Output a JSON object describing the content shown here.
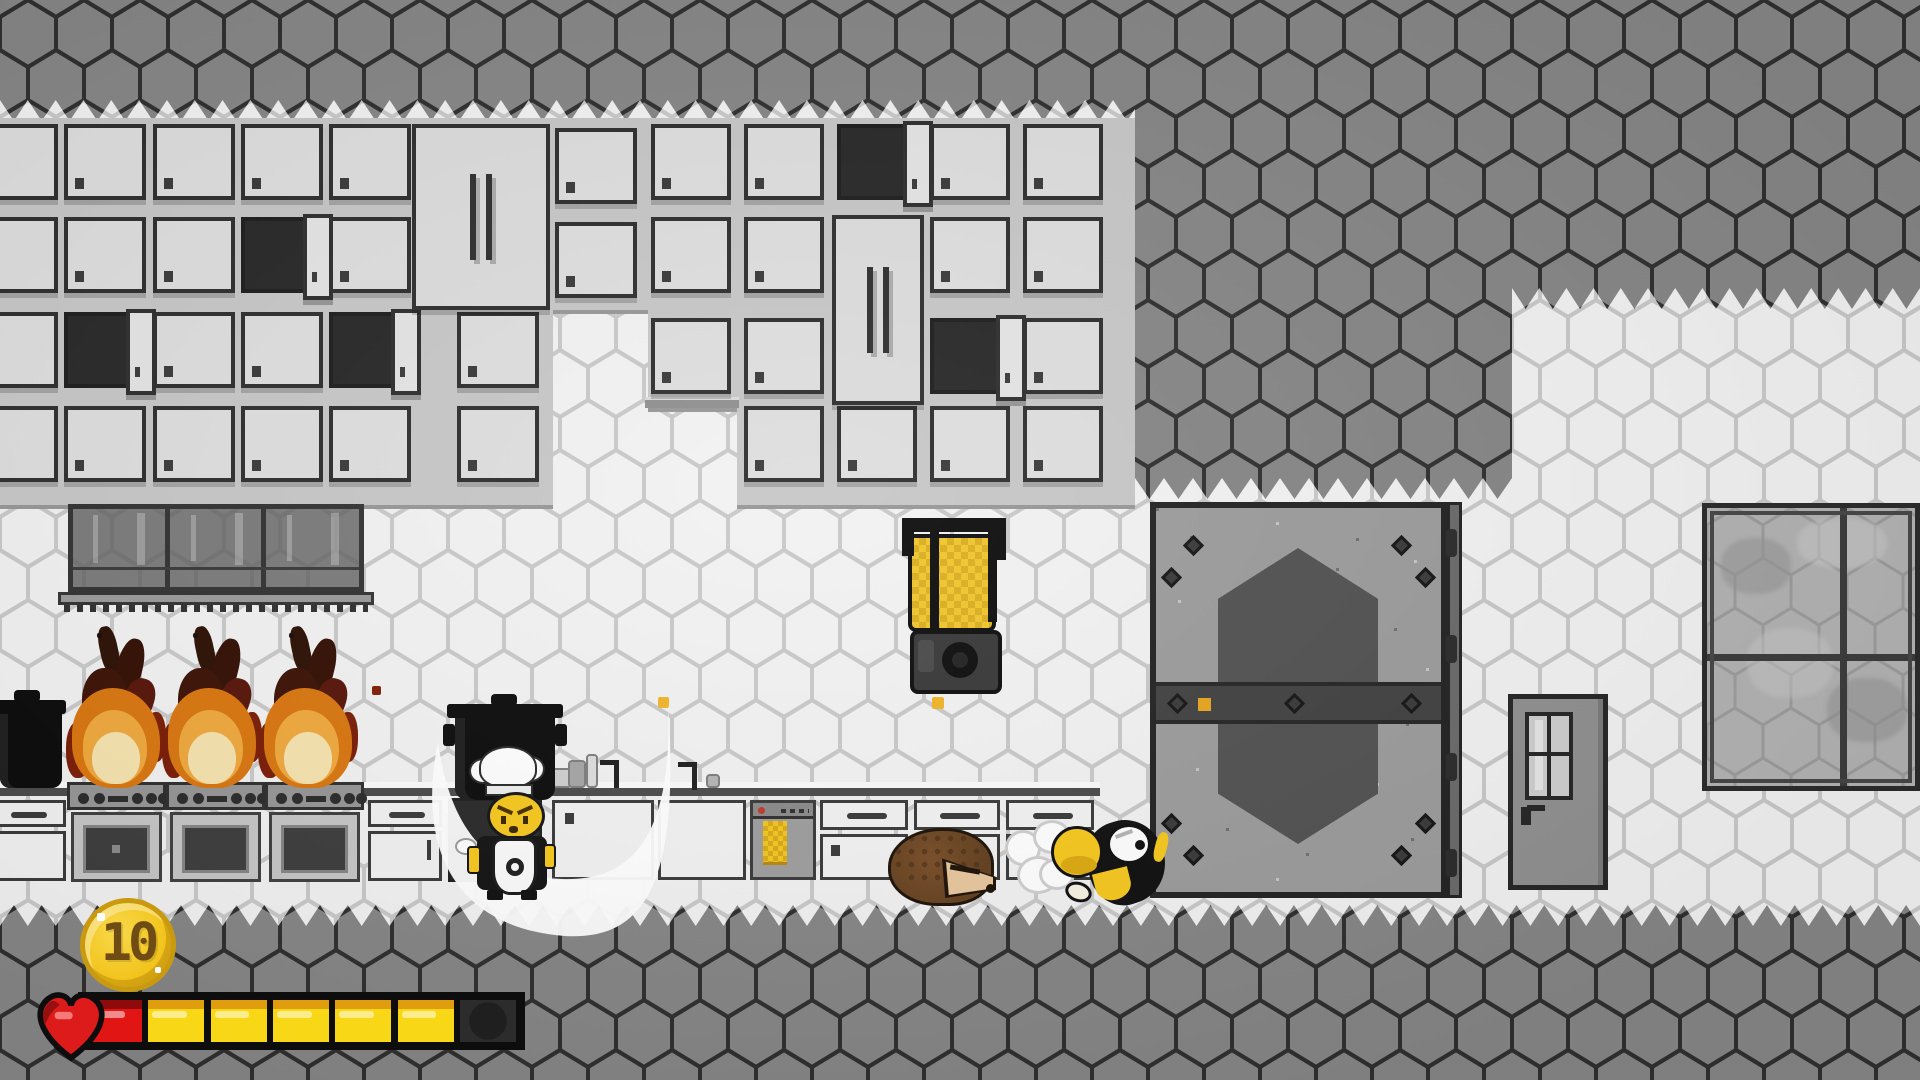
{
  "hud": {
    "coin_count": "10",
    "coin_icon": "gold-coin",
    "health": {
      "heart_icon": "pixel-heart",
      "segments": [
        "red",
        "yellow",
        "yellow",
        "yellow",
        "yellow",
        "yellow",
        "empty"
      ],
      "filled": 6,
      "total": 7
    }
  },
  "entities": {
    "player": "bee-rolling-with-dash-cloud",
    "npc": "chef-bee-with-pot",
    "creature": "hedgehog",
    "hazards": [
      "stove-fire",
      "stove-fire",
      "stove-fire"
    ],
    "props": [
      "blender-with-honey",
      "black-pot",
      "range-hood",
      "dishwasher",
      "sink-dishes",
      "honey-drop",
      "honey-drop",
      "ember"
    ],
    "structures": [
      "wall-cabinets",
      "vault-door",
      "kitchen-door",
      "window"
    ]
  },
  "colors": {
    "hex_wall_dark": "#868686",
    "hex_wall_light": "#f2f2f2",
    "hex_line_dark": "#2f2f2f",
    "hex_line_light": "#c9c9c9",
    "cabinet_door": "#dedede",
    "cabinet_frame": "#2e2e2e",
    "honey_yellow": "#f0c62c",
    "bee_yellow": "#f6c81e",
    "flame_orange": "#d9760f",
    "flame_core": "#f6e3ae",
    "health_red": "#e21515",
    "health_yellow": "#f8d816",
    "coin_gold": "#f2c41d",
    "vault_gray": "#9c9c9c"
  }
}
